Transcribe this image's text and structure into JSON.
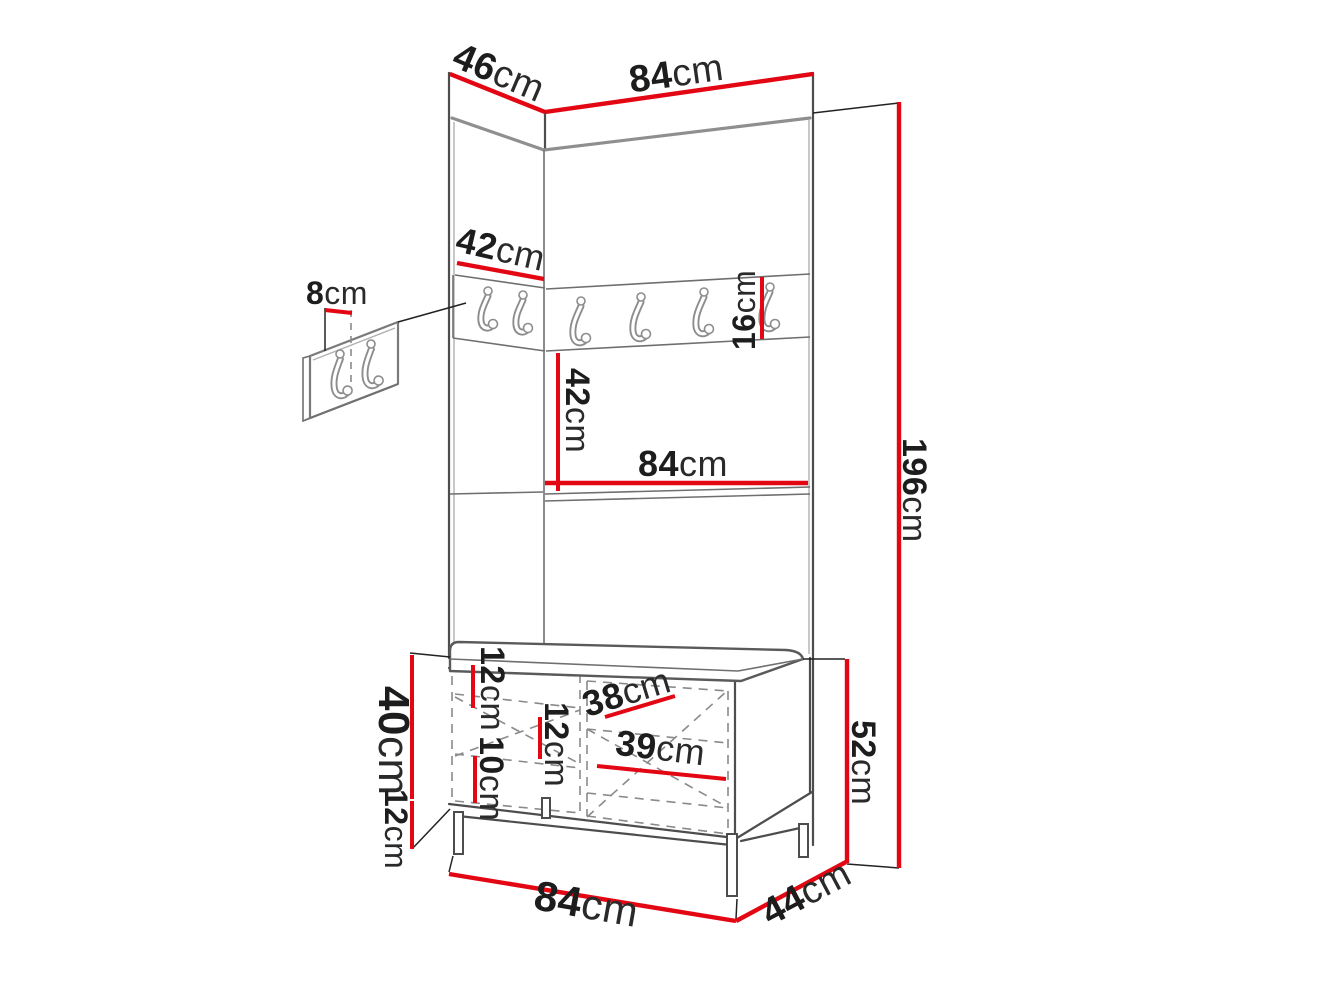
{
  "diagram": {
    "title": "Hallway set dimension drawing: tall hook panel with shelf and shoe bench",
    "unit": "cm",
    "colors": {
      "dimension_line": "#e30613",
      "outline": "#4d4d4d",
      "text": "#1d1d1d",
      "background": "#ffffff"
    },
    "dimensions": {
      "top_depth": {
        "value": "46",
        "unit": "cm"
      },
      "top_width": {
        "value": "84",
        "unit": "cm"
      },
      "wall_panel_width": {
        "value": "8",
        "unit": "cm"
      },
      "corner_panel_width": {
        "value": "42",
        "unit": "cm"
      },
      "hook_rail_height": {
        "value": "16",
        "unit": "cm"
      },
      "rail_to_shelf": {
        "value": "42",
        "unit": "cm"
      },
      "shelf_width": {
        "value": "84",
        "unit": "cm"
      },
      "total_height": {
        "value": "196",
        "unit": "cm"
      },
      "flap_top_height": {
        "value": "12",
        "unit": "cm"
      },
      "flap_mid_height": {
        "value": "12",
        "unit": "cm"
      },
      "flap_bottom_height": {
        "value": "10",
        "unit": "cm"
      },
      "left_door_width": {
        "value": "38",
        "unit": "cm"
      },
      "right_door_width": {
        "value": "39",
        "unit": "cm"
      },
      "bench_body_height": {
        "value": "40",
        "unit": "cm"
      },
      "leg_height": {
        "value": "12",
        "unit": "cm"
      },
      "bench_height": {
        "value": "52",
        "unit": "cm"
      },
      "bench_width": {
        "value": "84",
        "unit": "cm"
      },
      "bench_depth": {
        "value": "44",
        "unit": "cm"
      }
    }
  }
}
